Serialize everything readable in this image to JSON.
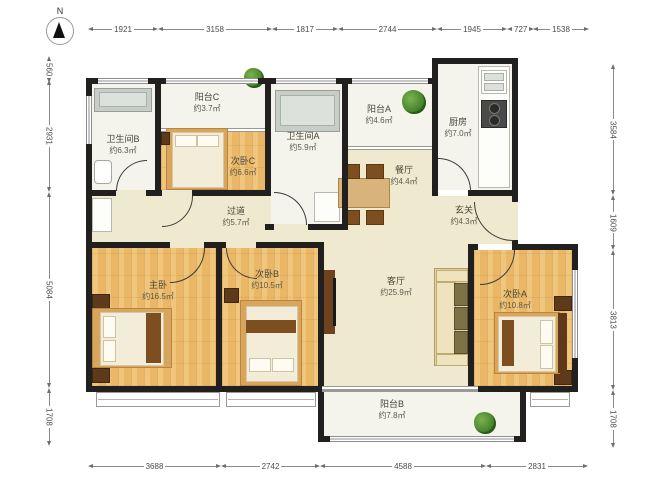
{
  "north_label": "N",
  "rooms": {
    "balcony_c": {
      "name": "阳台C",
      "area": "约3.7㎡"
    },
    "bath_b": {
      "name": "卫生间B",
      "area": "约6.3㎡"
    },
    "bed_c": {
      "name": "次卧C",
      "area": "约6.6㎡"
    },
    "bath_a": {
      "name": "卫生间A",
      "area": "约5.9㎡"
    },
    "balcony_a": {
      "name": "阳台A",
      "area": "约4.6㎡"
    },
    "kitchen": {
      "name": "厨房",
      "area": "约7.0㎡"
    },
    "dining": {
      "name": "餐厅",
      "area": "约4.4㎡"
    },
    "entry": {
      "name": "玄关",
      "area": "约4.3㎡"
    },
    "corridor": {
      "name": "过道",
      "area": "约5.7㎡"
    },
    "master": {
      "name": "主卧",
      "area": "约16.5㎡"
    },
    "bed_b": {
      "name": "次卧B",
      "area": "约10.5㎡"
    },
    "living": {
      "name": "客厅",
      "area": "约25.9㎡"
    },
    "bed_a": {
      "name": "次卧A",
      "area": "约10.8㎡"
    },
    "balcony_b": {
      "name": "阳台B",
      "area": "约7.8㎡"
    }
  },
  "dims": {
    "top": [
      "1921",
      "3158",
      "1817",
      "2744",
      "1945",
      "727",
      "1538"
    ],
    "bottom": [
      "3688",
      "2742",
      "4588",
      "2831"
    ],
    "left": [
      "560",
      "2931",
      "5084",
      "1708"
    ],
    "right": [
      "3584",
      "1609",
      "3813",
      "1708"
    ]
  },
  "colors": {
    "wall": "#22201e",
    "wood_floor": "#e9b766",
    "cream_floor": "#efe9cf",
    "plant_green": "#3c7a24"
  }
}
